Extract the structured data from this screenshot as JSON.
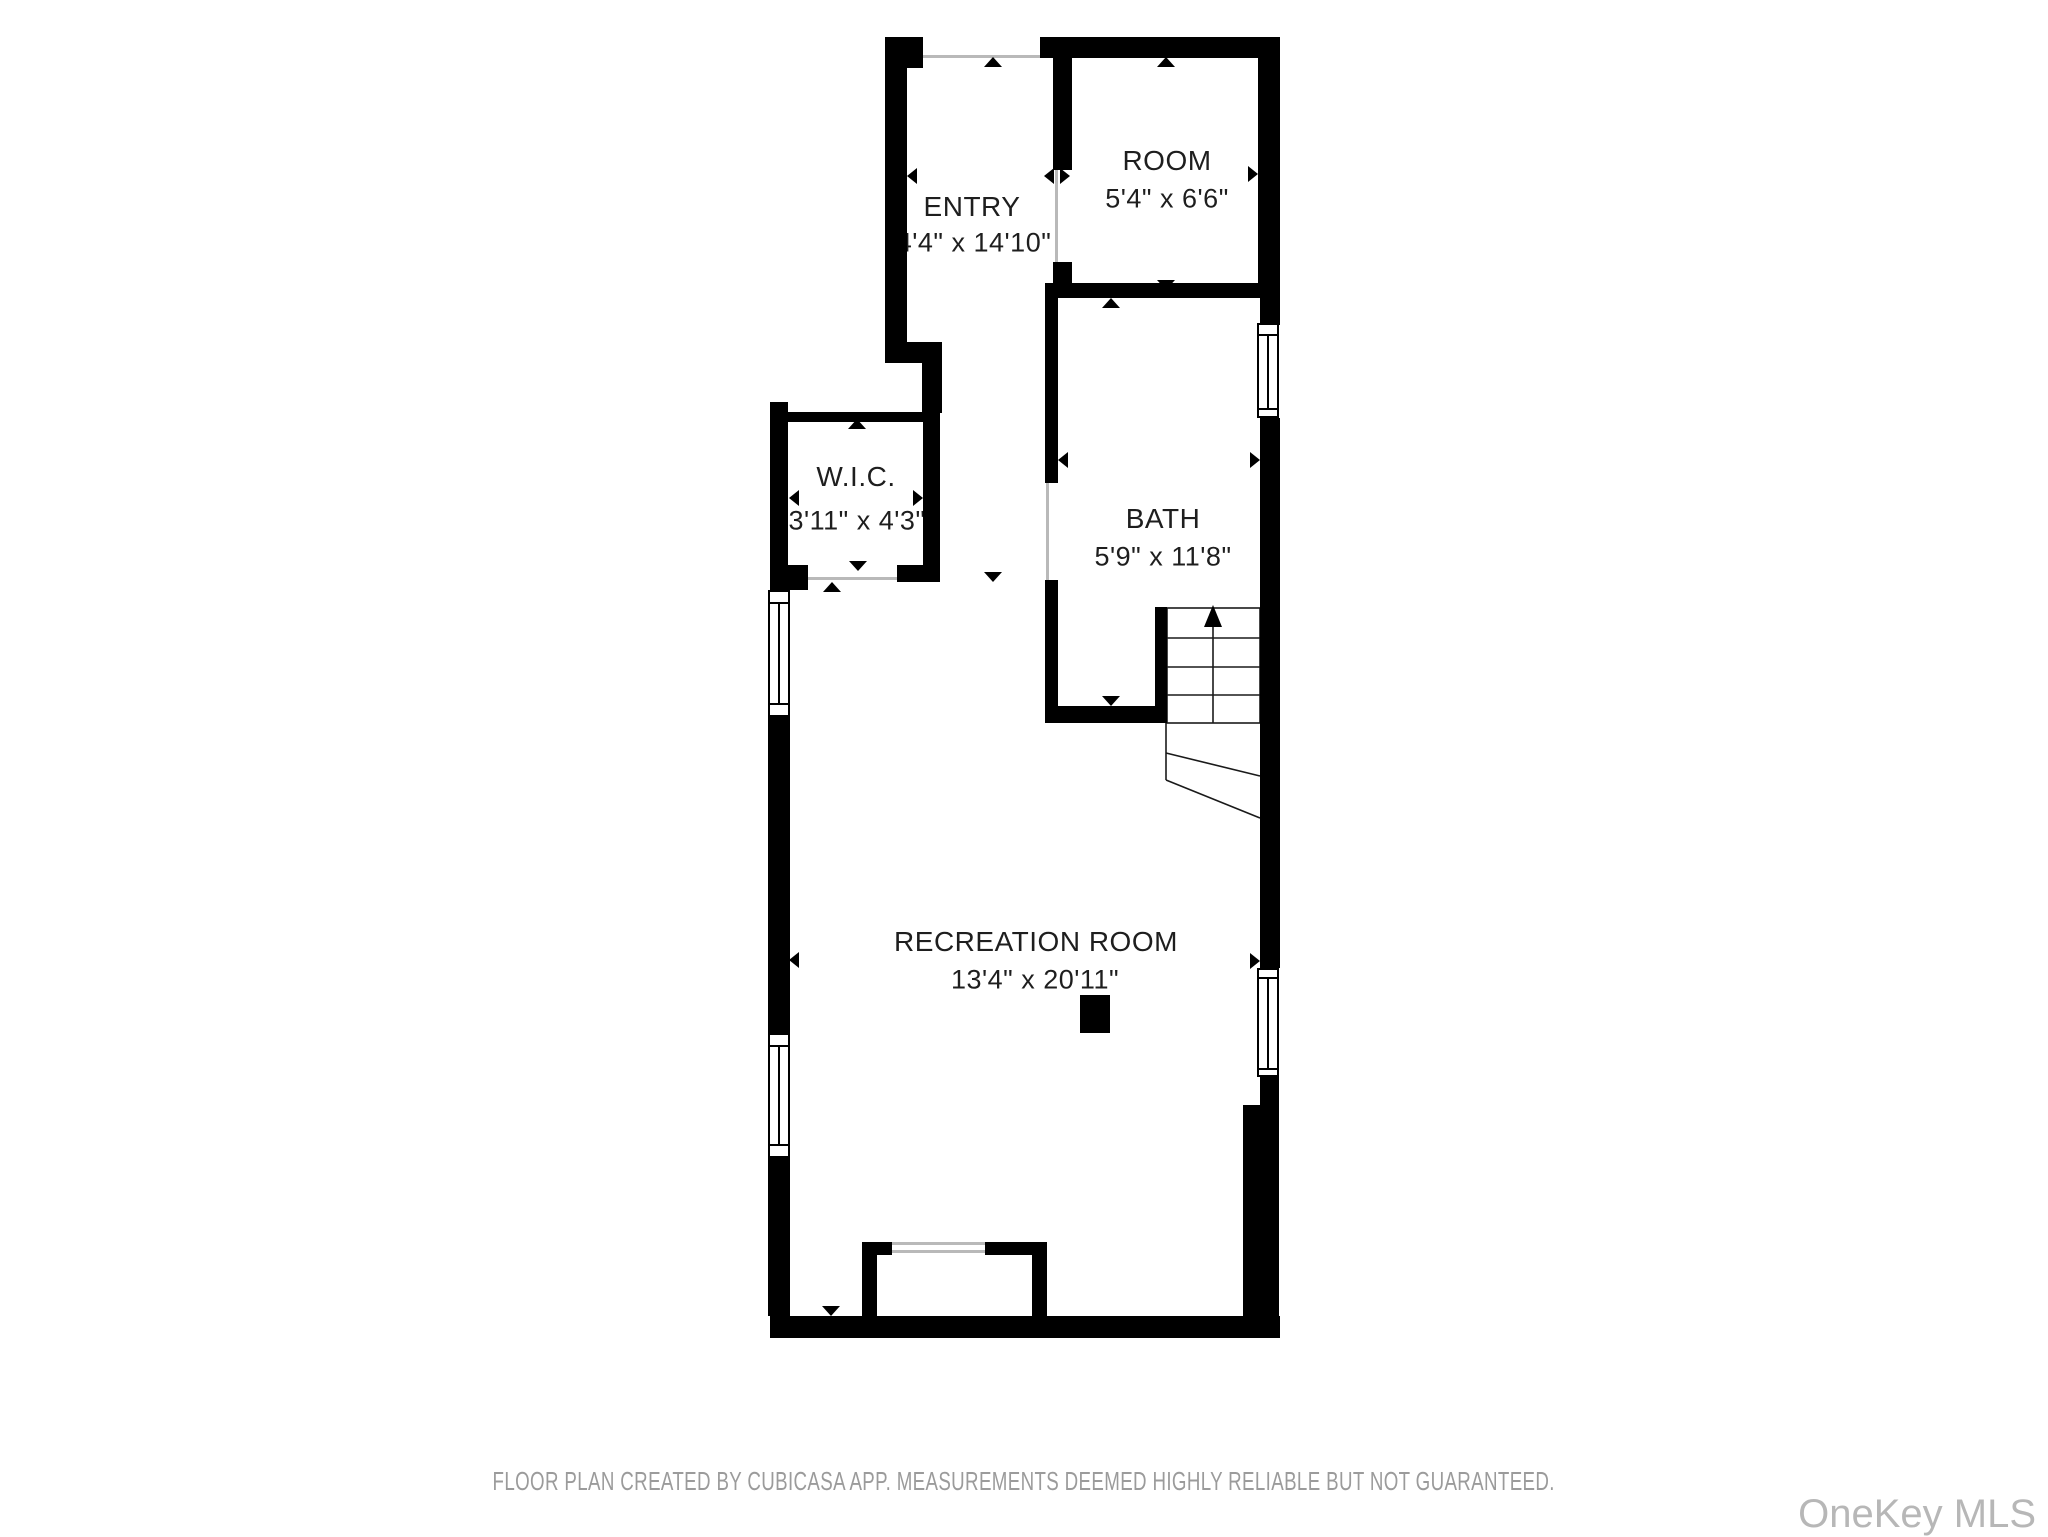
{
  "title": "Floor plan",
  "rooms": {
    "entry": {
      "name": "ENTRY",
      "dims": "4'4\" x 14'10\""
    },
    "room": {
      "name": "ROOM",
      "dims": "5'4\" x 6'6\""
    },
    "wic": {
      "name": "W.I.C.",
      "dims": "3'11\" x 4'3\""
    },
    "bath": {
      "name": "BATH",
      "dims": "5'9\" x 11'8\""
    },
    "recreation": {
      "name": "RECREATION ROOM",
      "dims": "13'4\" x 20'11\""
    }
  },
  "stairs": {
    "direction": "up"
  },
  "footer": {
    "disclaimer": "FLOOR PLAN CREATED BY CUBICASA APP. MEASUREMENTS DEEMED HIGHLY RELIABLE BUT NOT GUARANTEED."
  },
  "watermark": {
    "text": "OneKey MLS"
  },
  "colors": {
    "wall": "#000000",
    "label": "#1e1e1e",
    "threshold": "#b9b9b9",
    "footer_text": "#9b9b9b",
    "watermark_text": "#b7b7b7",
    "background": "#ffffff"
  }
}
